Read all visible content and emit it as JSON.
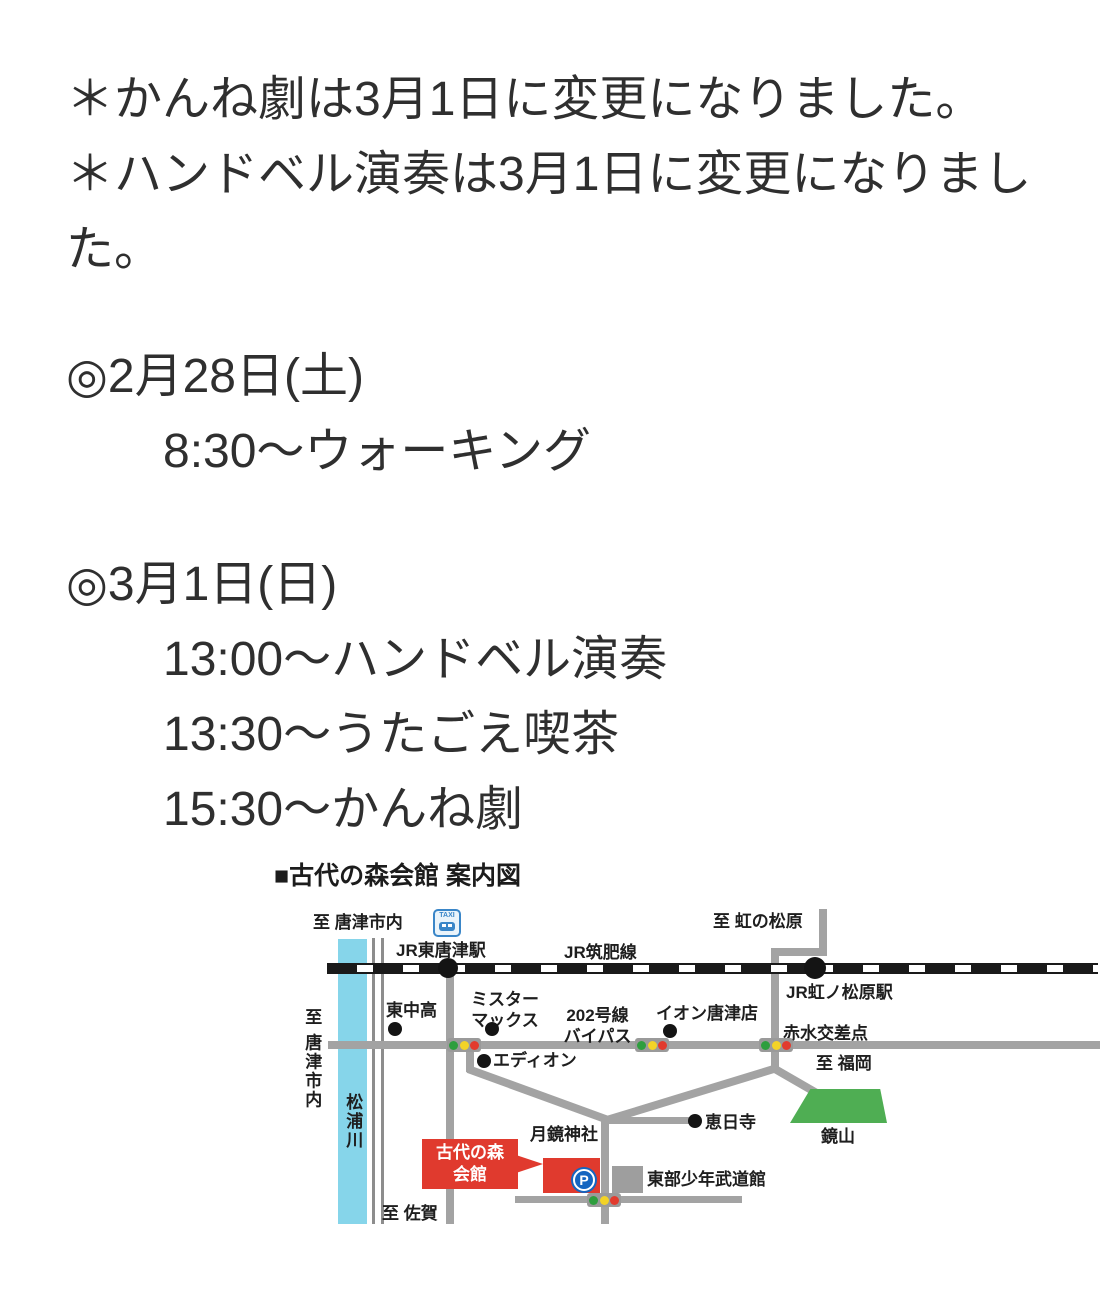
{
  "page": {
    "notice_lines": [
      "＊かんね劇は3月1日に変更になりました。",
      "＊ハンドベル演奏は3月1日に変更になりました。"
    ],
    "schedule": [
      {
        "date": "◎2月28日(土)",
        "items": [
          "8:30〜ウォーキング"
        ]
      },
      {
        "date": "◎3月1日(日)",
        "items": [
          "13:00〜ハンドベル演奏",
          "13:30〜うたごえ喫茶",
          "15:30〜かんね劇"
        ]
      }
    ]
  },
  "map": {
    "title": "■古代の森会館 案内図",
    "labels": {
      "to_karatsu_city_top": "至 唐津市内",
      "taxi": "TAXI",
      "jr_higashi_karatsu_sta": "JR東唐津駅",
      "jr_chikuhi_line": "JR筑肥線",
      "to_niji_no_matsubara": "至 虹の松原",
      "jr_niji_no_matsubara_sta": "JR虹ノ松原駅",
      "higashi_chu_ko": "東中高",
      "mr_max": "ミスター\nマックス",
      "route_202_bypass": "202号線\nバイパス",
      "aeon_karatsu": "イオン唐津店",
      "akamizu_crossing": "赤水交差点",
      "to_fukuoka": "至 福岡",
      "edion": "エディオン",
      "to_karatsu_city_left": "至 唐津市内",
      "matsuura_river": "松浦川",
      "enichi_temple": "恵日寺",
      "tsukikagami_shrine": "月鏡神社",
      "kagami_mountain": "鏡山",
      "kodai_no_mori_hall": "古代の森\n会館",
      "parking": "P",
      "tobu_budokan": "東部少年武道館",
      "to_saga": "至 佐賀"
    },
    "colors": {
      "river": "#86d5ea",
      "road": "#a3a3a3",
      "railway": "#1a1a1a",
      "accent_red": "#e03a2e",
      "mountain_green": "#4fae53",
      "parking_blue": "#1565c0",
      "signal_green": "#2e9e3e",
      "signal_yellow": "#f3d327",
      "signal_red": "#e23b2e"
    }
  }
}
